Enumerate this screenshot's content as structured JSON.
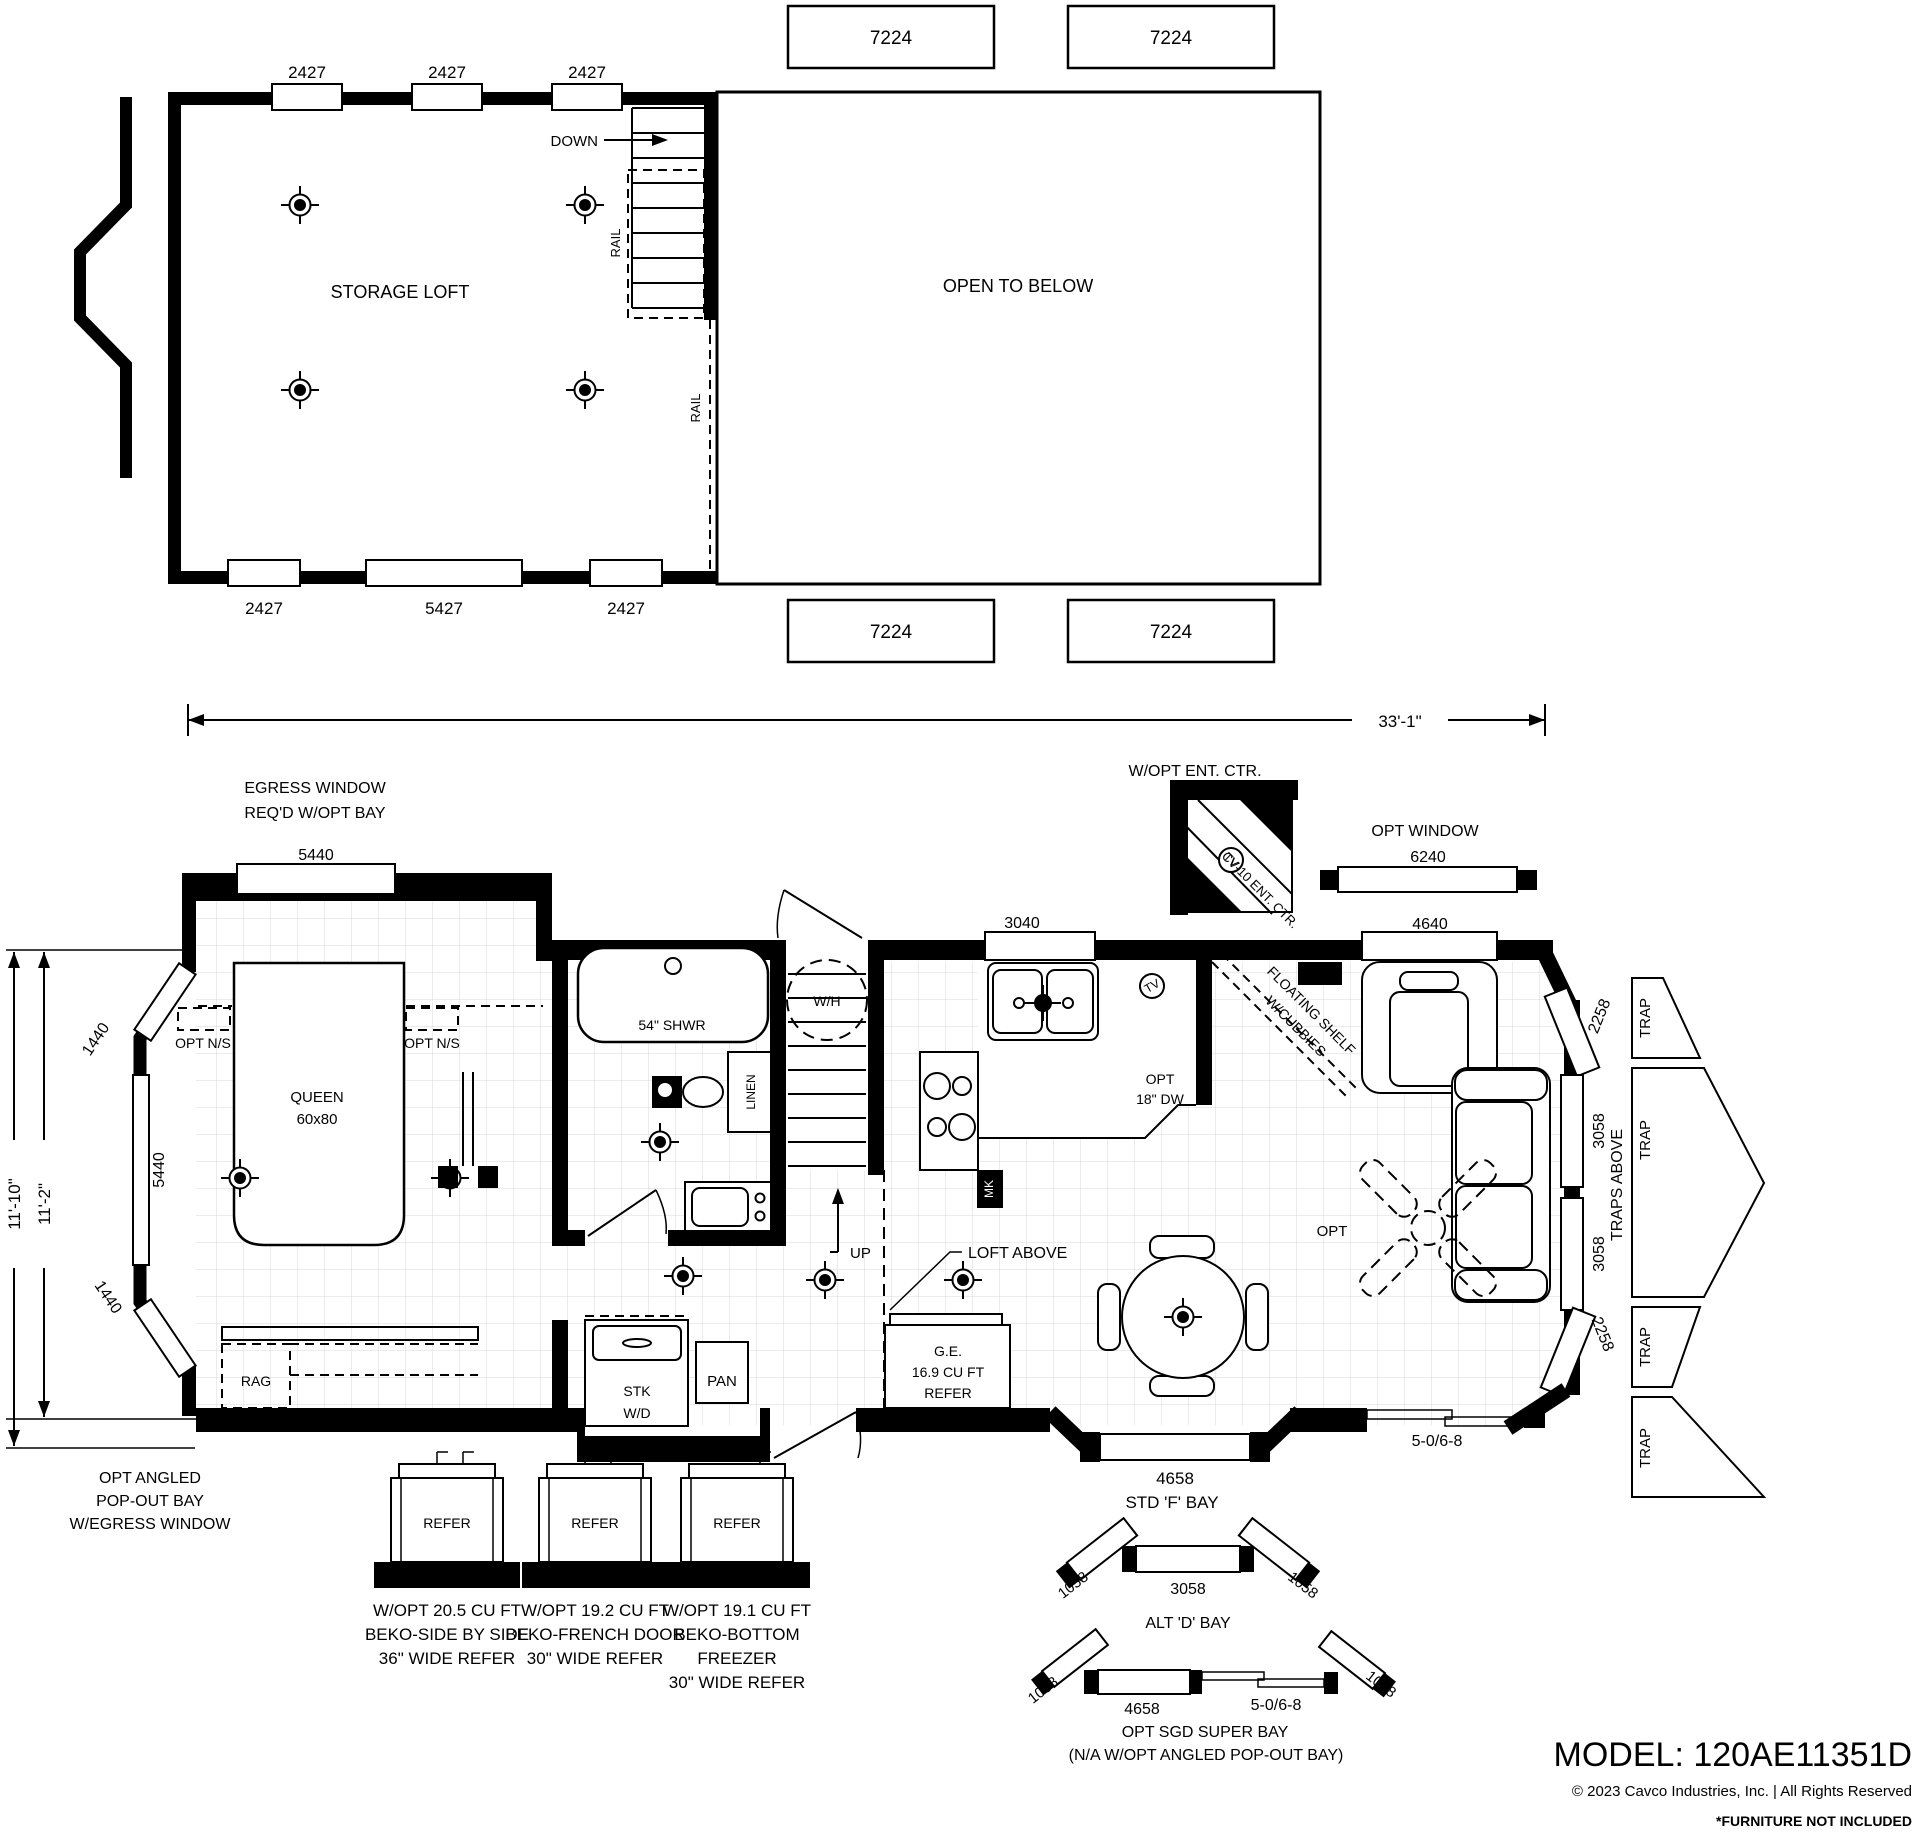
{
  "colors": {
    "ink": "#000000",
    "grid": "#d8d8d8",
    "paper": "#ffffff"
  },
  "loft": {
    "title": "STORAGE LOFT",
    "open_to_below": "OPEN TO BELOW",
    "down": "DOWN",
    "rail_stairs": "RAIL",
    "rail_edge": "RAIL",
    "win_top": [
      "2427",
      "2427",
      "2427"
    ],
    "win_bottom": [
      "2427",
      "5427",
      "2427"
    ],
    "win_side_top": [
      "7224",
      "7224"
    ],
    "win_side_bottom": [
      "7224",
      "7224"
    ]
  },
  "main": {
    "dim_overall": "33'-1\"",
    "dim_outer": "11'-10\"",
    "dim_inner": "11'-2\"",
    "egress_line1": "EGRESS WINDOW",
    "egress_line2": "REQ'D W/OPT BAY",
    "win_egress": "5440",
    "ent_note": "W/OPT ENT. CTR.",
    "ent_unit": "CV-10 ENT. CTR.",
    "tv_ent": "TV",
    "tv_wall": "TV",
    "opt_window_line1": "OPT WINDOW",
    "opt_window_dim": "6240",
    "win_3040": "3040",
    "win_4640": "4640",
    "oh": "STD 'A' O.H.",
    "ns_left": "OPT N/S",
    "ns_right": "OPT N/S",
    "bed_line1": "QUEEN",
    "bed_line2": "60x80",
    "win_5440_side": "5440",
    "win_1440_top": "1440",
    "win_1440_bottom": "1440",
    "rag": "RAG",
    "shower": "54\" SHWR",
    "linen": "LINEN",
    "water_heater": "W/H",
    "up": "UP",
    "stk_line1": "STK",
    "stk_line2": "W/D",
    "pan": "PAN",
    "mk": "MK",
    "dw_line1": "OPT",
    "dw_line2": "18\" DW",
    "shelf_line1": "FLOATING SHELF",
    "shelf_line2": "W/CUBBIES",
    "loft_above": "LOFT ABOVE",
    "refer_line1": "G.E.",
    "refer_line2": "16.9 CU FT",
    "refer_line3": "REFER",
    "fan": "OPT",
    "traps_above": "TRAPS ABOVE",
    "traps": [
      "TRAP",
      "TRAP",
      "TRAP",
      "TRAP"
    ],
    "win_2258_top": "2258",
    "win_3058_top": "3058",
    "win_3058_bottom": "3058",
    "win_2258_bottom": "2258",
    "door_sgd": "5-0/6-8",
    "fbay_dim": "4658",
    "fbay_label": "STD 'F' BAY",
    "popout_line1": "OPT ANGLED",
    "popout_line2": "POP-OUT BAY",
    "popout_line3": "W/EGRESS WINDOW"
  },
  "options": {
    "refers": [
      {
        "tag": "REFER",
        "line1": "W/OPT 20.5 CU FT",
        "line2": "BEKO-SIDE BY SIDE",
        "line3": "36\" WIDE REFER"
      },
      {
        "tag": "REFER",
        "line1": "W/OPT 19.2 CU FT",
        "line2": "BEKO-FRENCH DOOR",
        "line3": "30\" WIDE REFER"
      },
      {
        "tag": "REFER",
        "line1": "W/OPT 19.1 CU FT",
        "line2": "BEKO-BOTTOM",
        "line3": "FREEZER",
        "line4": "30\" WIDE REFER"
      }
    ],
    "alt_bay": {
      "dim_left": "1058",
      "dim_center": "3058",
      "dim_right": "1058",
      "label": "ALT 'D' BAY"
    },
    "super_bay": {
      "dim_left": "1058",
      "dim_window": "4658",
      "dim_door": "5-0/6-8",
      "dim_right": "1058",
      "label_line1": "OPT SGD SUPER BAY",
      "label_line2": "(N/A W/OPT ANGLED POP-OUT BAY)"
    }
  },
  "footer": {
    "model": "MODEL: 120AE11351D",
    "copyright": "© 2023 Cavco Industries, Inc. | All Rights Reserved",
    "note": "*FURNITURE NOT INCLUDED"
  }
}
